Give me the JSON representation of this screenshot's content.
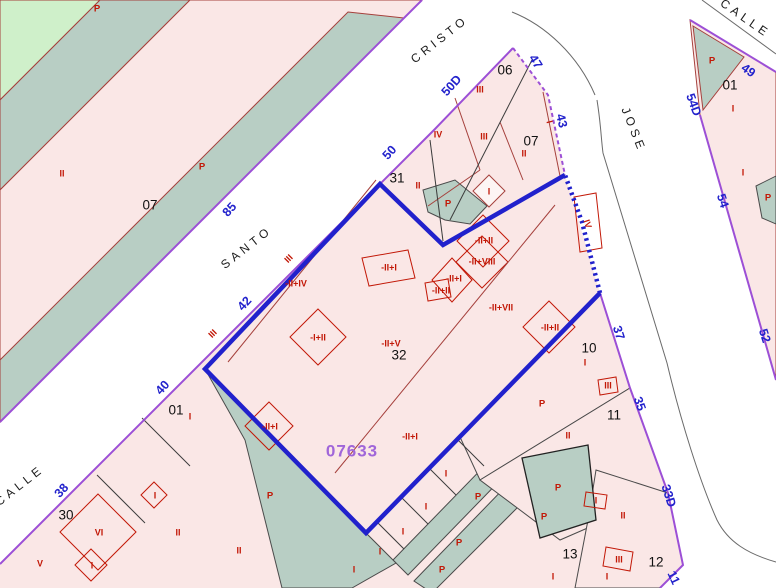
{
  "map": {
    "reference": {
      "text": "07633"
    },
    "p_label": "P",
    "colors": {
      "parcel_pink": "#FAE7E6",
      "courtyard_teal": "#B8CEC4",
      "land_green": "#CFF0CA",
      "parcel_line_red": "#A5403C",
      "mark_red": "#C21807",
      "street_edge_purple": "#9C4FD6",
      "selection_blue": "#2121CC",
      "street_number_blue": "#2222CC",
      "reference_purple": "#A066D9"
    },
    "street_names": [
      {
        "text": "CRISTO",
        "x": 440,
        "y": 40,
        "rot": -38
      },
      {
        "text": "SANTO",
        "x": 247,
        "y": 248,
        "rot": -38
      },
      {
        "text": "CALLE",
        "x": 20,
        "y": 486,
        "rot": -38
      },
      {
        "text": "CALLE",
        "x": 745,
        "y": 19,
        "rot": 35
      },
      {
        "text": "JOSE",
        "x": 633,
        "y": 130,
        "rot": 68
      }
    ],
    "street_numbers": [
      {
        "text": "85",
        "x": 230,
        "y": 210,
        "rot": -48
      },
      {
        "text": "50",
        "x": 390,
        "y": 153,
        "rot": -48
      },
      {
        "text": "50D",
        "x": 452,
        "y": 86,
        "rot": -48
      },
      {
        "text": "47",
        "x": 535,
        "y": 62,
        "rot": 58
      },
      {
        "text": "43",
        "x": 561,
        "y": 121,
        "rot": 76
      },
      {
        "text": "42",
        "x": 245,
        "y": 304,
        "rot": -48
      },
      {
        "text": "40",
        "x": 163,
        "y": 388,
        "rot": -48
      },
      {
        "text": "38",
        "x": 62,
        "y": 491,
        "rot": -48
      },
      {
        "text": "49",
        "x": 748,
        "y": 71,
        "rot": 36
      },
      {
        "text": "54D",
        "x": 693,
        "y": 105,
        "rot": 70
      },
      {
        "text": "54",
        "x": 722,
        "y": 201,
        "rot": 72
      },
      {
        "text": "52",
        "x": 764,
        "y": 336,
        "rot": 72
      },
      {
        "text": "37",
        "x": 618,
        "y": 333,
        "rot": 72
      },
      {
        "text": "35",
        "x": 639,
        "y": 404,
        "rot": 70
      },
      {
        "text": "33D",
        "x": 668,
        "y": 496,
        "rot": 72
      },
      {
        "text": "11",
        "x": 673,
        "y": 578,
        "rot": 65
      }
    ],
    "parcel_numbers": [
      {
        "text": "06",
        "x": 505,
        "y": 71
      },
      {
        "text": "07",
        "x": 531,
        "y": 142
      },
      {
        "text": "31",
        "x": 397,
        "y": 179
      },
      {
        "text": "32",
        "x": 399,
        "y": 356
      },
      {
        "text": "07",
        "x": 150,
        "y": 206
      },
      {
        "text": "01",
        "x": 730,
        "y": 86
      },
      {
        "text": "01",
        "x": 176,
        "y": 411
      },
      {
        "text": "10",
        "x": 589,
        "y": 349
      },
      {
        "text": "11",
        "x": 614,
        "y": 416
      },
      {
        "text": "30",
        "x": 66,
        "y": 516
      },
      {
        "text": "13",
        "x": 570,
        "y": 555
      },
      {
        "text": "12",
        "x": 656,
        "y": 563
      }
    ],
    "red_marks": [
      {
        "text": "II",
        "x": 62,
        "y": 174,
        "rot": 0
      },
      {
        "text": "III",
        "x": 289,
        "y": 259,
        "rot": -45
      },
      {
        "text": "III",
        "x": 213,
        "y": 334,
        "rot": -45
      },
      {
        "text": "-II+IV",
        "x": 296,
        "y": 284,
        "rot": 0
      },
      {
        "text": "-II+I",
        "x": 389,
        "y": 268,
        "rot": 0
      },
      {
        "text": "-I+II",
        "x": 318,
        "y": 338,
        "rot": 0
      },
      {
        "text": "-II+V",
        "x": 391,
        "y": 344,
        "rot": 0
      },
      {
        "text": "II",
        "x": 418,
        "y": 186,
        "rot": 0
      },
      {
        "text": "I",
        "x": 489,
        "y": 192,
        "rot": 0
      },
      {
        "text": "III",
        "x": 480,
        "y": 90,
        "rot": 0
      },
      {
        "text": "IV",
        "x": 438,
        "y": 135,
        "rot": 0
      },
      {
        "text": "III",
        "x": 484,
        "y": 137,
        "rot": 0
      },
      {
        "text": "II",
        "x": 524,
        "y": 154,
        "rot": 0
      },
      {
        "text": "I",
        "x": 549,
        "y": 122,
        "rot": 76
      },
      {
        "text": "IV",
        "x": 587,
        "y": 224,
        "rot": 72
      },
      {
        "text": "-II+II",
        "x": 484,
        "y": 241,
        "rot": 0
      },
      {
        "text": "-II+VIII",
        "x": 482,
        "y": 262,
        "rot": 0
      },
      {
        "text": "-II+I",
        "x": 454,
        "y": 279,
        "rot": 0
      },
      {
        "text": "-II+II",
        "x": 441,
        "y": 291,
        "rot": 0
      },
      {
        "text": "-II+VII",
        "x": 501,
        "y": 308,
        "rot": 0
      },
      {
        "text": "-II+II",
        "x": 550,
        "y": 328,
        "rot": 0
      },
      {
        "text": "-II+I",
        "x": 270,
        "y": 427,
        "rot": 0
      },
      {
        "text": "-II+I",
        "x": 410,
        "y": 437,
        "rot": 0
      },
      {
        "text": "I",
        "x": 585,
        "y": 363,
        "rot": 0
      },
      {
        "text": "III",
        "x": 608,
        "y": 386,
        "rot": 0
      },
      {
        "text": "II",
        "x": 568,
        "y": 436,
        "rot": 0
      },
      {
        "text": "I",
        "x": 596,
        "y": 501,
        "rot": 0
      },
      {
        "text": "II",
        "x": 623,
        "y": 516,
        "rot": 0
      },
      {
        "text": "III",
        "x": 619,
        "y": 560,
        "rot": 0
      },
      {
        "text": "I",
        "x": 553,
        "y": 577,
        "rot": 0
      },
      {
        "text": "I",
        "x": 607,
        "y": 577,
        "rot": 0
      },
      {
        "text": "I",
        "x": 446,
        "y": 474,
        "rot": 0
      },
      {
        "text": "I",
        "x": 426,
        "y": 507,
        "rot": 0
      },
      {
        "text": "I",
        "x": 403,
        "y": 532,
        "rot": 0
      },
      {
        "text": "I",
        "x": 380,
        "y": 552,
        "rot": 0
      },
      {
        "text": "I",
        "x": 354,
        "y": 570,
        "rot": 0
      },
      {
        "text": "I",
        "x": 190,
        "y": 417,
        "rot": 0
      },
      {
        "text": "VI",
        "x": 99,
        "y": 533,
        "rot": 0
      },
      {
        "text": "I",
        "x": 155,
        "y": 496,
        "rot": 0
      },
      {
        "text": "V",
        "x": 40,
        "y": 564,
        "rot": 0
      },
      {
        "text": "I",
        "x": 92,
        "y": 566,
        "rot": 0
      },
      {
        "text": "II",
        "x": 178,
        "y": 533,
        "rot": 0
      },
      {
        "text": "II",
        "x": 239,
        "y": 551,
        "rot": 0
      },
      {
        "text": "I",
        "x": 733,
        "y": 109,
        "rot": 0
      },
      {
        "text": "I",
        "x": 743,
        "y": 173,
        "rot": 0
      }
    ],
    "p_marks": [
      {
        "x": 97,
        "y": 9
      },
      {
        "x": 202,
        "y": 167
      },
      {
        "x": 448,
        "y": 204
      },
      {
        "x": 712,
        "y": 61
      },
      {
        "x": 768,
        "y": 198
      },
      {
        "x": 542,
        "y": 404
      },
      {
        "x": 558,
        "y": 488
      },
      {
        "x": 544,
        "y": 517
      },
      {
        "x": 478,
        "y": 497
      },
      {
        "x": 459,
        "y": 543
      },
      {
        "x": 442,
        "y": 570
      },
      {
        "x": 270,
        "y": 496
      }
    ]
  }
}
